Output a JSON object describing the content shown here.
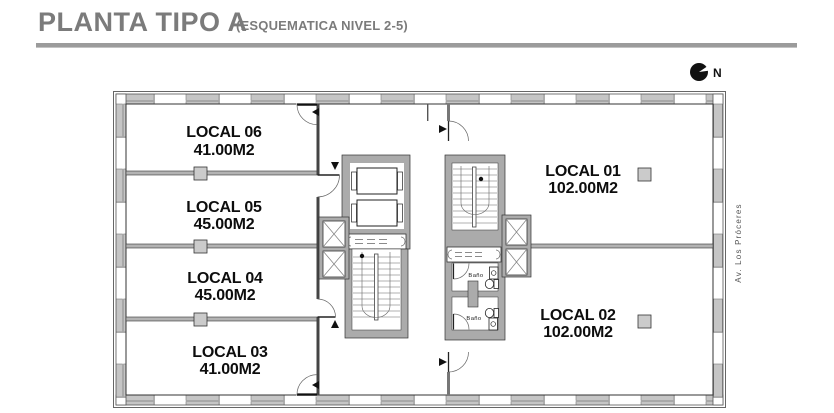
{
  "header": {
    "title": "PLANTA TIPO A",
    "subtitle": "(ESQUEMATICA NIVEL 2-5)"
  },
  "compass": {
    "label": "N"
  },
  "street": {
    "label": "Av. Los Próceres"
  },
  "plan": {
    "locals": [
      {
        "name": "LOCAL 01",
        "area": "102.00M2"
      },
      {
        "name": "LOCAL 02",
        "area": "102.00M2"
      },
      {
        "name": "LOCAL 03",
        "area": "41.00M2"
      },
      {
        "name": "LOCAL 04",
        "area": "45.00M2"
      },
      {
        "name": "LOCAL 05",
        "area": "45.00M2"
      },
      {
        "name": "LOCAL 06",
        "area": "41.00M2"
      }
    ],
    "baths": [
      {
        "label": "Baño"
      },
      {
        "label": "Baño"
      }
    ]
  },
  "colors": {
    "title_gray": "#7b7b7b",
    "divider_gray": "#9b9b9b",
    "wall_fill": "#ababab",
    "glass_fill": "#c5c5c5",
    "line": "#333333"
  }
}
